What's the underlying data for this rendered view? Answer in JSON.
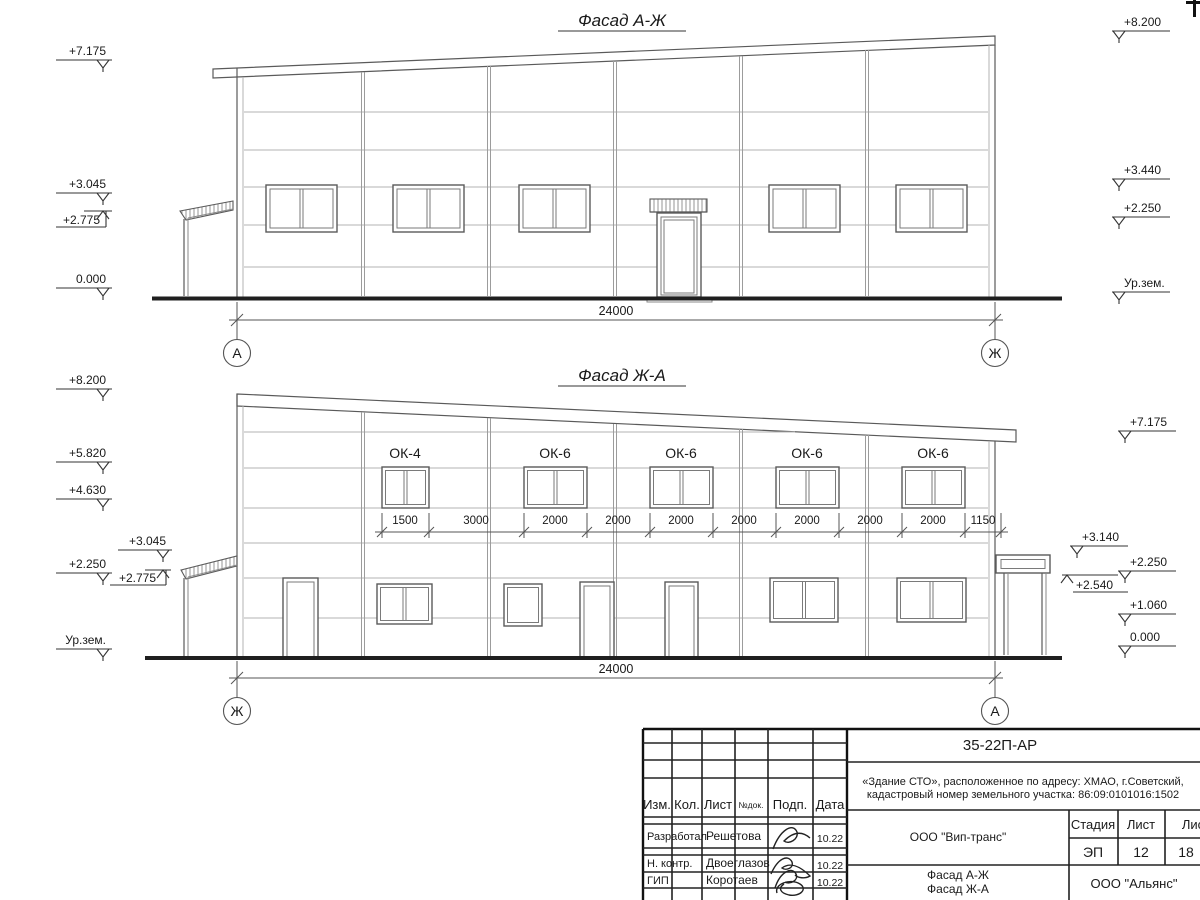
{
  "colors": {
    "background": "#ffffff",
    "outline": "#5a5a5a",
    "panel_line": "#b3b3b3",
    "thick_line": "#1f1f1f",
    "text": "#1a1a1a"
  },
  "facade_top": {
    "title": "Фасад А-Ж",
    "axis_left": "А",
    "axis_right": "Ж",
    "span_dim": "24000",
    "marks_left": [
      "+7.175",
      "+3.045",
      "+2.775",
      "0.000"
    ],
    "marks_right": [
      "+8.200",
      "+3.440",
      "+2.250",
      "Ур.зем."
    ]
  },
  "facade_bottom": {
    "title": "Фасад Ж-А",
    "axis_left": "Ж",
    "axis_right": "А",
    "span_dim": "24000",
    "window_labels": [
      "ОК-4",
      "ОК-6",
      "ОК-6",
      "ОК-6",
      "ОК-6"
    ],
    "dims": [
      "1500",
      "3000",
      "2000",
      "2000",
      "2000",
      "2000",
      "2000",
      "2000",
      "2000",
      "1150"
    ],
    "marks_left": [
      "+8.200",
      "+5.820",
      "+4.630",
      "+3.045",
      "+2.250",
      "+2.775",
      "Ур.зем."
    ],
    "marks_right": [
      "+7.175",
      "+3.140",
      "+2.250",
      "+2.540",
      "+1.060",
      "0.000"
    ]
  },
  "title_block": {
    "doc_number": "35-22П-АР",
    "project_line1": "«Здание СТО», расположенное по адресу: ХМАО, г.Советский,",
    "project_line2": "кадастровый номер земельного участка: 86:09:0101016:1502",
    "col_izm": "Изм.",
    "col_kol": "Кол.",
    "col_list": "Лист",
    "col_ndok": "№док.",
    "col_podp": "Подп.",
    "col_data": "Дата",
    "rows": [
      {
        "role": "Разработал",
        "name": "Решетова",
        "date": "10.22"
      },
      {
        "role": "Н. контр.",
        "name": "Двоеглазов",
        "date": "10.22"
      },
      {
        "role": "ГИП",
        "name": "Коротаев",
        "date": "10.22"
      }
    ],
    "company": "ООО \"Вип-транс\"",
    "stage_label": "Стадия",
    "sheet_label": "Лист",
    "sheets_label": "Листов",
    "stage_value": "ЭП",
    "sheet_value": "12",
    "sheets_value": "18",
    "drawing_title_line1": "Фасад А-Ж",
    "drawing_title_line2": "Фасад Ж-А",
    "contractor": "ООО \"Альянс\""
  }
}
